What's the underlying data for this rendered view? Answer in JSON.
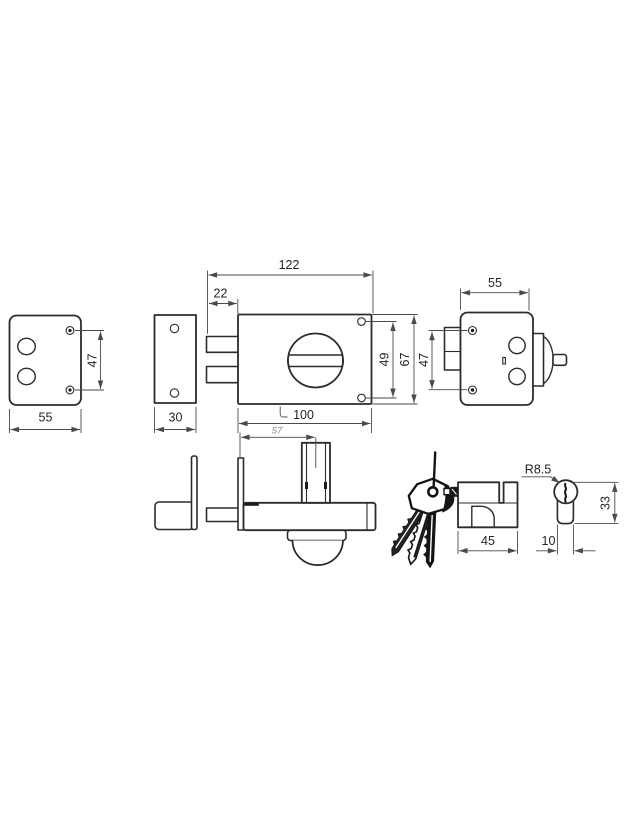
{
  "canvas": {
    "background": "#ffffff",
    "line_color": "#2c2c2c",
    "dim_color": "#4a4a4a",
    "text_color": "#242424",
    "muted_text_color": "#8d8d8d"
  },
  "views": {
    "strike_plate_front": {
      "width": "55",
      "screw_spacing": "47"
    },
    "cover_plate": {
      "width": "30"
    },
    "lock_front": {
      "overall_width": "122",
      "bolt_throw": "22",
      "body_width": "100",
      "screw_spacing": "49",
      "body_height": "67"
    },
    "lock_side": {
      "width": "55",
      "screw_spacing": "47"
    },
    "lock_top": {
      "cylinder_offset": "57"
    },
    "cylinder_with_keys": {
      "length": "45"
    },
    "cylinder_profile": {
      "radius": "R8.5",
      "height": "33",
      "stem_width": "10"
    }
  }
}
